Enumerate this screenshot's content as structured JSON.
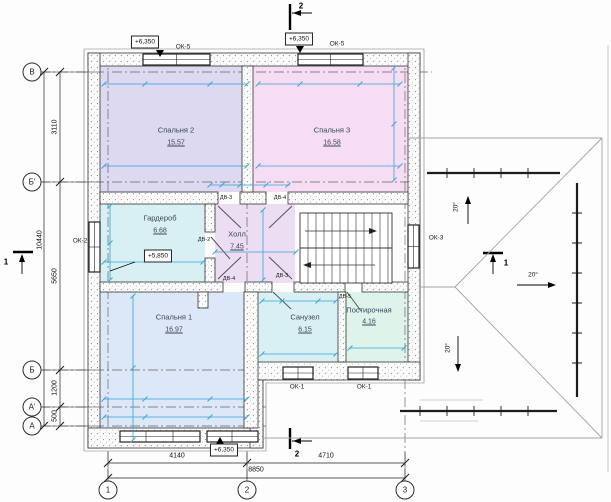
{
  "colors": {
    "dimension_blue": "#35a3d9",
    "line_black": "#1a1a1a",
    "roof_gray": "#a0a4aa",
    "bedroom2_fill": "#dcd9f1",
    "bedroom3_fill": "#f7ddf3",
    "wardrobe_fill": "#d8f0f4",
    "hall_fill": "#ecddf2",
    "bedroom1_fill": "#dce7f7",
    "bathroom_fill": "#d8f0f4",
    "laundry_fill": "#def4ea"
  },
  "rooms": [
    {
      "name": "Спальня 2",
      "area": "15.57"
    },
    {
      "name": "Спальня 3",
      "area": "16.58"
    },
    {
      "name": "Гардероб",
      "area": "6.68"
    },
    {
      "name": "Холл",
      "area": "7.45"
    },
    {
      "name": "Спальня 1",
      "area": "16.97"
    },
    {
      "name": "Санузел",
      "area": "6.15"
    },
    {
      "name": "Постирочная",
      "area": "4.16"
    }
  ],
  "elevations": {
    "top_left": "+6,350",
    "top_right": "+6,350",
    "bottom": "+6,350",
    "wardrobe": "+5,850"
  },
  "windows": {
    "ok5_left": "ОК-5",
    "ok5_right": "ОК-5",
    "ok2": "ОК-2",
    "ok3": "ОК-3",
    "ok1_left": "ОК-1",
    "ok1_right": "ОК-1"
  },
  "doors": {
    "hall_to_bedroom2": "ДВ-3",
    "hall_to_bedroom3": "ДВ-4",
    "hall_to_wardrobe": "ДВ-2",
    "hall_to_bedroom1": "ДВ-4",
    "hall_to_bathroom": "ДВ-3",
    "laundry": "ДВ-5"
  },
  "axes": {
    "rows": [
      "В",
      "Б'",
      "Б",
      "А'",
      "А"
    ],
    "cols": [
      "1",
      "2",
      "3"
    ]
  },
  "dimensions": {
    "left_chain": [
      "3110",
      "5650",
      "1200",
      "500"
    ],
    "left_total": "10440",
    "bottom_chain": [
      "4140",
      "4710"
    ],
    "bottom_total": "8850"
  },
  "roof": {
    "slopes": [
      "20°",
      "20°",
      "20°"
    ]
  },
  "sections": {
    "s1": "1",
    "s2": "2"
  }
}
